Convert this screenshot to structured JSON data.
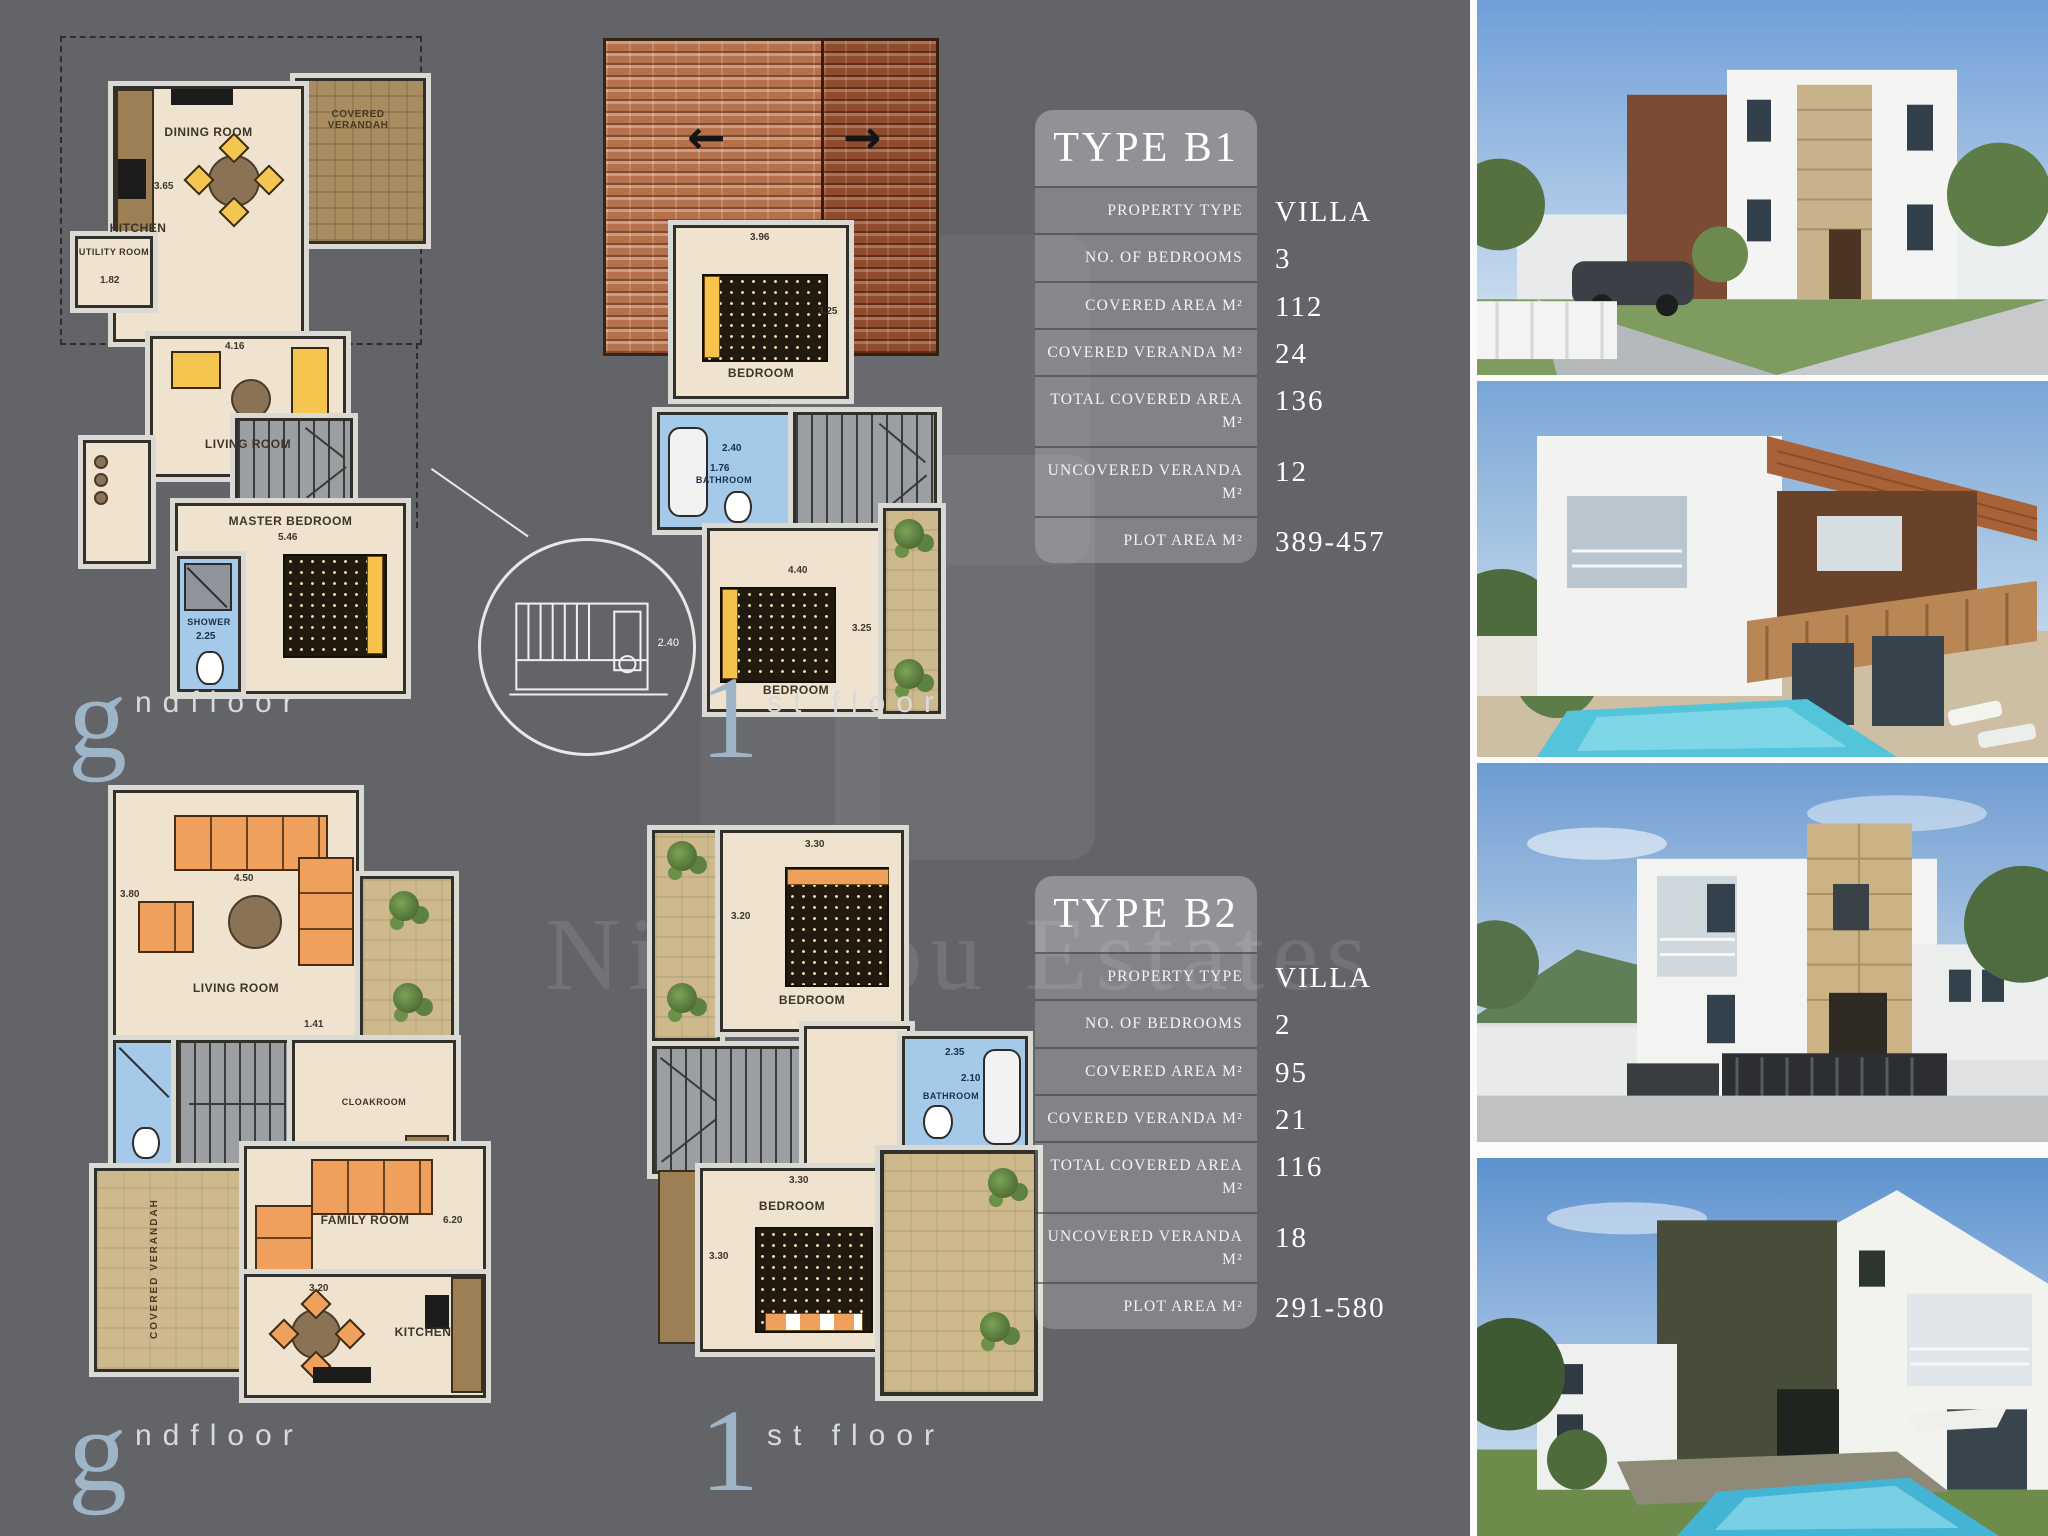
{
  "watermark": {
    "text": "Nicolaou Estates"
  },
  "floor_labels": {
    "ground_initial": "g",
    "ground_rest": "ndfloor",
    "first_initial": "1",
    "first_rest": "st floor"
  },
  "tables": [
    {
      "title": "TYPE B1",
      "rows": [
        {
          "label": "PROPERTY TYPE",
          "value": "VILLA"
        },
        {
          "label": "NO. OF BEDROOMS",
          "value": "3"
        },
        {
          "label": "COVERED AREA M²",
          "value": "112"
        },
        {
          "label": "COVERED VERANDA M²",
          "value": "24"
        },
        {
          "label": "TOTAL COVERED AREA M²",
          "value": "136"
        },
        {
          "label": "UNCOVERED VERANDA M²",
          "value": "12"
        },
        {
          "label": "PLOT AREA M²",
          "value": "389-457"
        }
      ]
    },
    {
      "title": "TYPE B2",
      "rows": [
        {
          "label": "PROPERTY TYPE",
          "value": "VILLA"
        },
        {
          "label": "NO. OF BEDROOMS",
          "value": "2"
        },
        {
          "label": "COVERED AREA M²",
          "value": "95"
        },
        {
          "label": "COVERED VERANDA M²",
          "value": "21"
        },
        {
          "label": "TOTAL COVERED AREA M²",
          "value": "116"
        },
        {
          "label": "UNCOVERED VERANDA M²",
          "value": "18"
        },
        {
          "label": "PLOT AREA M²",
          "value": "291-580"
        }
      ]
    }
  ],
  "plans": {
    "b1_ground": {
      "rooms": {
        "dining": "DINING ROOM",
        "kitchen": "KITCHEN",
        "verandah": "COVERED VERANDAH",
        "utility": "UTILITY ROOM",
        "living": "LIVING ROOM",
        "master": "MASTER BEDROOM",
        "shower": "SHOWER"
      },
      "dims": {
        "kitchen": "3.65",
        "utility": "1.82",
        "living": "4.16",
        "master": "5.46",
        "shower": "2.25"
      }
    },
    "b1_first": {
      "rooms": {
        "bedroom1": "BEDROOM",
        "bathroom": "BATHROOM",
        "bedroom2": "BEDROOM"
      },
      "dims": {
        "bedroom1_w": "3.96",
        "bedroom1_h": "3.25",
        "bathroom_w": "2.40",
        "bathroom_h": "1.76",
        "bedroom2_w": "4.40",
        "bedroom2_h": "3.25"
      }
    },
    "b2_ground": {
      "rooms": {
        "living": "LIVING ROOM",
        "cloakroom": "CLOAKROOM",
        "verandah": "COVERED VERANDAH",
        "family": "FAMILY ROOM",
        "kitchen": "KITCHEN"
      },
      "dims": {
        "living_w": "4.50",
        "living_h": "3.80",
        "hall": "1.41",
        "family": "6.20",
        "kitchen": "3.20"
      }
    },
    "b2_first": {
      "rooms": {
        "bedroom1": "BEDROOM",
        "bathroom": "BATHROOM",
        "bedroom2": "BEDROOM"
      },
      "dims": {
        "bedroom1_w": "3.30",
        "bedroom1_h": "3.20",
        "bathroom_w": "2.35",
        "bathroom_h": "2.10",
        "bedroom2_w": "3.30",
        "bedroom2_h": "3.30"
      }
    },
    "callout": {
      "dim": "2.40"
    }
  },
  "colors": {
    "background": "#626468",
    "room_fill": "#efe3cf",
    "veranda_tan": "#cdb98c",
    "bathroom_blue": "#a5c9e8",
    "roof_terracotta": "#b5714b",
    "accent_steel_blue": "#9db5c6"
  }
}
